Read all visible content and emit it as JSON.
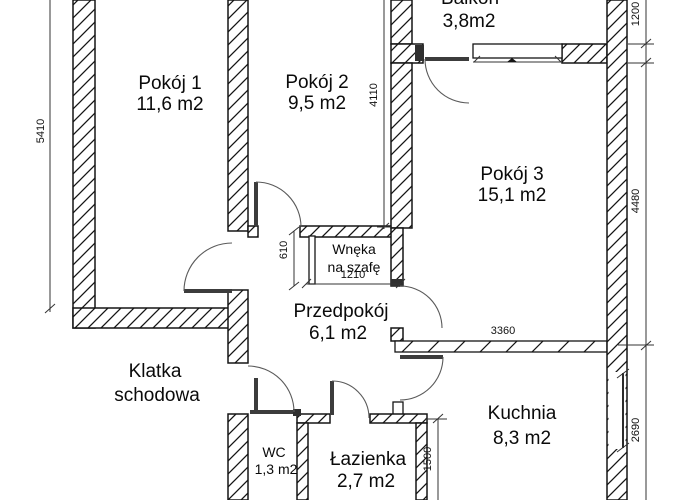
{
  "rooms": {
    "pokoj1": {
      "name": "Pokój 1",
      "area": "11,6 m2"
    },
    "pokoj2": {
      "name": "Pokój 2",
      "area": "9,5 m2"
    },
    "pokoj3": {
      "name": "Pokój 3",
      "area": "15,1 m2"
    },
    "balkon": {
      "name": "Balkon",
      "area": "3,8m2"
    },
    "przedpokoj": {
      "name": "Przedpokój",
      "area": "6,1 m2"
    },
    "kuchnia": {
      "name": "Kuchnia",
      "area": "8,3 m2"
    },
    "lazienka": {
      "name": "Łazienka",
      "area": "2,7 m2"
    },
    "wc": {
      "name": "WC",
      "area": "1,3 m2"
    },
    "wneka": {
      "line1": "Wnęka",
      "line2": "na szafę"
    },
    "klatka": {
      "line1": "Klatka",
      "line2": "schodowa"
    }
  },
  "dimensions": {
    "left_wall": "5410",
    "pokoj2_depth": "4110",
    "balkon_height": "1200",
    "pokoj3_depth": "4480",
    "wneka_depth": "610",
    "wneka_width": "1210",
    "kuchnia_wall": "3360",
    "kuchnia_window": "2690",
    "lazienka_depth": "1500"
  }
}
